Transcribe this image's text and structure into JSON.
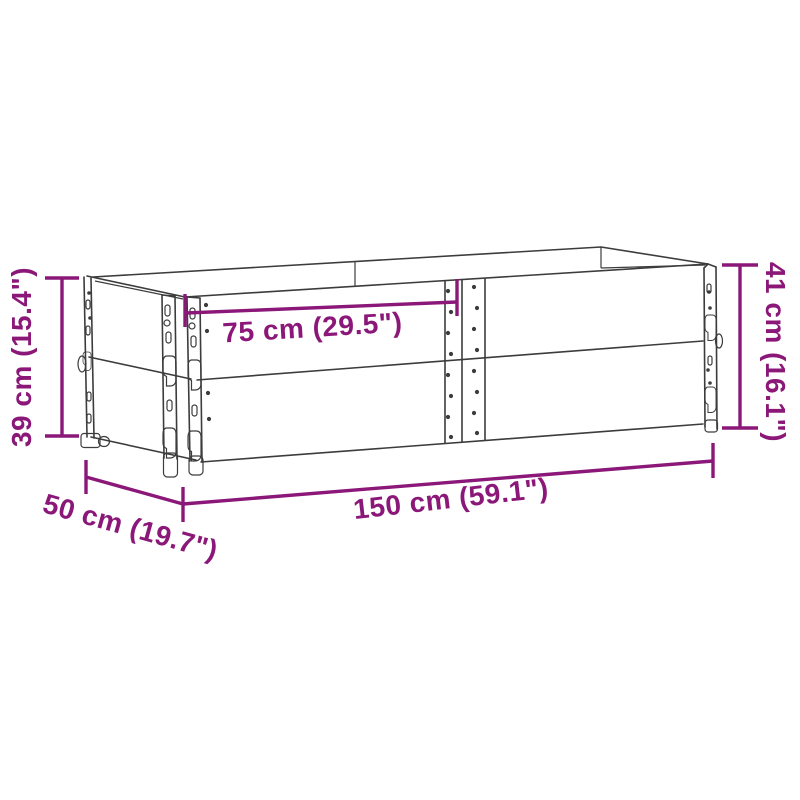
{
  "page": {
    "background": "#ffffff",
    "width": 800,
    "height": 800
  },
  "diagram": {
    "kind": "product-dimension-line-drawing",
    "subject": "wooden pallet collar raised bed, two stacked collars, perspective view",
    "colors": {
      "accent": "#8B1879",
      "line": "#3C3C3C",
      "background": "#ffffff"
    },
    "dimensions": [
      {
        "name": "inner-width",
        "label": "75 cm (29.5\")"
      },
      {
        "name": "left-height",
        "label": "39 cm (15.4\")"
      },
      {
        "name": "right-height",
        "label": "41 cm (16.1\")"
      },
      {
        "name": "length",
        "label": "150 cm (59.1\")"
      },
      {
        "name": "depth",
        "label": "50 cm (19.7\")"
      }
    ]
  }
}
